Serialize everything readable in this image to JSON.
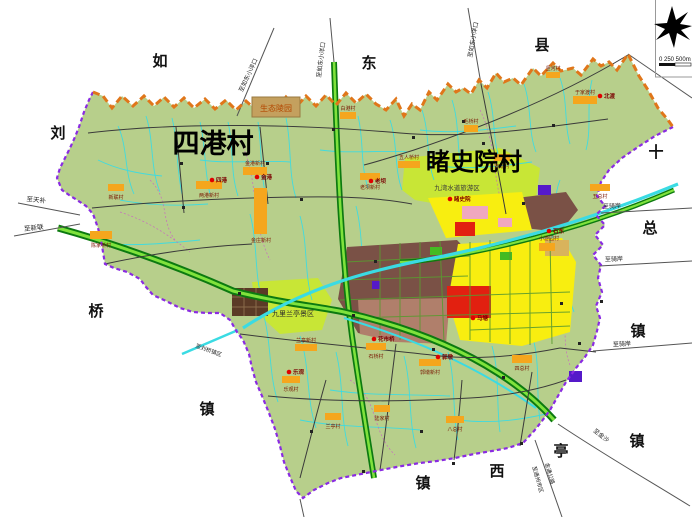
{
  "map": {
    "region_titles": [
      {
        "text": "四港村",
        "x": 213,
        "y": 153,
        "size": 27
      },
      {
        "text": "睹史院村",
        "x": 474,
        "y": 170,
        "size": 24
      }
    ],
    "edge_labels": [
      {
        "text": "如",
        "x": 160,
        "y": 66
      },
      {
        "text": "东",
        "x": 369,
        "y": 68
      },
      {
        "text": "县",
        "x": 542,
        "y": 50
      },
      {
        "text": "刘",
        "x": 58,
        "y": 138
      },
      {
        "text": "十",
        "x": 656,
        "y": 157
      },
      {
        "text": "总",
        "x": 650,
        "y": 233
      },
      {
        "text": "桥",
        "x": 96,
        "y": 316
      },
      {
        "text": "镇",
        "x": 207,
        "y": 414
      },
      {
        "text": "镇",
        "x": 423,
        "y": 488
      },
      {
        "text": "西",
        "x": 497,
        "y": 476
      },
      {
        "text": "亭",
        "x": 561,
        "y": 456
      },
      {
        "text": "镇",
        "x": 638,
        "y": 336
      },
      {
        "text": "镇",
        "x": 637,
        "y": 446
      }
    ],
    "area_labels": [
      {
        "text": "生态陵园",
        "x": 276,
        "y": 111,
        "size": 8,
        "color": "#b34700"
      },
      {
        "text": "九湾水道旅游区",
        "x": 457,
        "y": 190,
        "size": 6.5,
        "color": "#3a3a3a"
      },
      {
        "text": "九里兰亭景区",
        "x": 293,
        "y": 316,
        "size": 7,
        "color": "#2a2a2a"
      }
    ],
    "road_labels": [
      {
        "text": "至天补",
        "x": 36,
        "y": 202,
        "size": 6.5,
        "rotate": 6
      },
      {
        "text": "至新联",
        "x": 34,
        "y": 230,
        "size": 6.5,
        "rotate": -6
      },
      {
        "text": "至如东小洋口",
        "x": 250,
        "y": 76,
        "size": 6,
        "rotate": -65
      },
      {
        "text": "至如东小洋口",
        "x": 323,
        "y": 60,
        "size": 6,
        "rotate": -83
      },
      {
        "text": "至如东小洋口",
        "x": 475,
        "y": 40,
        "size": 6,
        "rotate": -80
      },
      {
        "text": "至骑岸",
        "x": 612,
        "y": 208,
        "size": 6,
        "rotate": -2
      },
      {
        "text": "至骑岸",
        "x": 614,
        "y": 261,
        "size": 6,
        "rotate": -2
      },
      {
        "text": "至骑岸",
        "x": 622,
        "y": 346,
        "size": 6,
        "rotate": -3
      },
      {
        "text": "至金沙",
        "x": 600,
        "y": 437,
        "size": 6,
        "rotate": 38
      },
      {
        "text": "至通州市区",
        "x": 536,
        "y": 480,
        "size": 5.5,
        "rotate": 74
      },
      {
        "text": "金通公路",
        "x": 548,
        "y": 474,
        "size": 5.5,
        "rotate": 74
      },
      {
        "text": "至刘桥镇区",
        "x": 208,
        "y": 352,
        "size": 5.5,
        "rotate": 20
      }
    ],
    "settlements": [
      {
        "name": "四港",
        "x": 212,
        "y": 180
      },
      {
        "name": "金港",
        "x": 257,
        "y": 177
      },
      {
        "name": "北渡",
        "x": 600,
        "y": 96
      },
      {
        "name": "老坝",
        "x": 371,
        "y": 181
      },
      {
        "name": "睹史院",
        "x": 450,
        "y": 199
      },
      {
        "name": "石东",
        "x": 549,
        "y": 231
      },
      {
        "name": "马塘",
        "x": 473,
        "y": 318
      },
      {
        "name": "花市桥",
        "x": 374,
        "y": 339
      },
      {
        "name": "郭墩",
        "x": 438,
        "y": 357
      },
      {
        "name": "乐观",
        "x": 289,
        "y": 372
      }
    ],
    "village_boxes": [
      {
        "label": "两港新村",
        "x": 196,
        "y": 181,
        "w": 26,
        "h": 8,
        "lx": 209,
        "ly": 197
      },
      {
        "label": "金港新村",
        "x": 243,
        "y": 167,
        "w": 24,
        "h": 8,
        "lx": 255,
        "ly": 165
      },
      {
        "label": "金庄新村",
        "x": 254,
        "y": 188,
        "w": 13,
        "h": 46,
        "lx": 261,
        "ly": 242
      },
      {
        "label": "新联村",
        "x": 108,
        "y": 184,
        "w": 16,
        "h": 7,
        "lx": 116,
        "ly": 199
      },
      {
        "label": "陈家桥村",
        "x": 90,
        "y": 231,
        "w": 22,
        "h": 8,
        "lx": 101,
        "ly": 247
      },
      {
        "label": "白港村",
        "x": 340,
        "y": 112,
        "w": 16,
        "h": 7,
        "lx": 348,
        "ly": 110
      },
      {
        "label": "老坝新村",
        "x": 360,
        "y": 173,
        "w": 20,
        "h": 7,
        "lx": 370,
        "ly": 189
      },
      {
        "label": "五人桥村",
        "x": 398,
        "y": 161,
        "w": 22,
        "h": 7,
        "lx": 409,
        "ly": 159
      },
      {
        "label": "石北村",
        "x": 494,
        "y": 154,
        "w": 16,
        "h": 7,
        "lx": 502,
        "ly": 168
      },
      {
        "label": "毛桥村",
        "x": 464,
        "y": 125,
        "w": 14,
        "h": 7,
        "lx": 471,
        "ly": 123
      },
      {
        "label": "于家渡村",
        "x": 573,
        "y": 96,
        "w": 24,
        "h": 8,
        "lx": 585,
        "ly": 94
      },
      {
        "label": "竖河村",
        "x": 546,
        "y": 72,
        "w": 14,
        "h": 6,
        "lx": 553,
        "ly": 70
      },
      {
        "label": "五总村",
        "x": 590,
        "y": 184,
        "w": 20,
        "h": 7,
        "lx": 600,
        "ly": 198
      },
      {
        "label": "小游园村",
        "x": 539,
        "y": 243,
        "w": 16,
        "h": 8,
        "lx": 549,
        "ly": 240
      },
      {
        "label": "石桥村",
        "x": 366,
        "y": 343,
        "w": 20,
        "h": 7,
        "lx": 376,
        "ly": 358
      },
      {
        "label": "郭墩新村",
        "x": 419,
        "y": 359,
        "w": 22,
        "h": 7,
        "lx": 430,
        "ly": 374
      },
      {
        "label": "四总村",
        "x": 512,
        "y": 355,
        "w": 20,
        "h": 8,
        "lx": 522,
        "ly": 370
      },
      {
        "label": "乐观村",
        "x": 282,
        "y": 376,
        "w": 18,
        "h": 7,
        "lx": 291,
        "ly": 391
      },
      {
        "label": "陆家村",
        "x": 374,
        "y": 405,
        "w": 16,
        "h": 7,
        "lx": 382,
        "ly": 420
      },
      {
        "label": "八总村",
        "x": 446,
        "y": 416,
        "w": 18,
        "h": 7,
        "lx": 455,
        "ly": 431
      },
      {
        "label": "兰亭新村",
        "x": 295,
        "y": 344,
        "w": 22,
        "h": 7,
        "lx": 306,
        "ly": 342
      },
      {
        "label": "兰亭村",
        "x": 325,
        "y": 413,
        "w": 16,
        "h": 7,
        "lx": 333,
        "ly": 428
      }
    ],
    "scale": {
      "text": "0 250 500m"
    },
    "icons": {
      "compass": "north-arrow-icon"
    },
    "colors": {
      "land": "#b7cf8b",
      "scenic_green": "#c8e636",
      "highway_dark": "#0c7a10",
      "highway_light": "#7fe23c",
      "river_cyan": "#3adbe3",
      "boundary_purple": "#8a2be2",
      "boundary_orange": "#e0761a",
      "urban_brown": "#7a5146",
      "urban_rosy": "#b07f6b",
      "block_yellow": "#f8ee10",
      "block_red": "#e22010",
      "block_pink": "#f0a8c0",
      "block_purple": "#5519c9",
      "village_orange": "#f5a61d",
      "settlement_dot": "#e00000",
      "village_label": "#7a1400",
      "eco_park_fill": "#c4a05e"
    }
  }
}
